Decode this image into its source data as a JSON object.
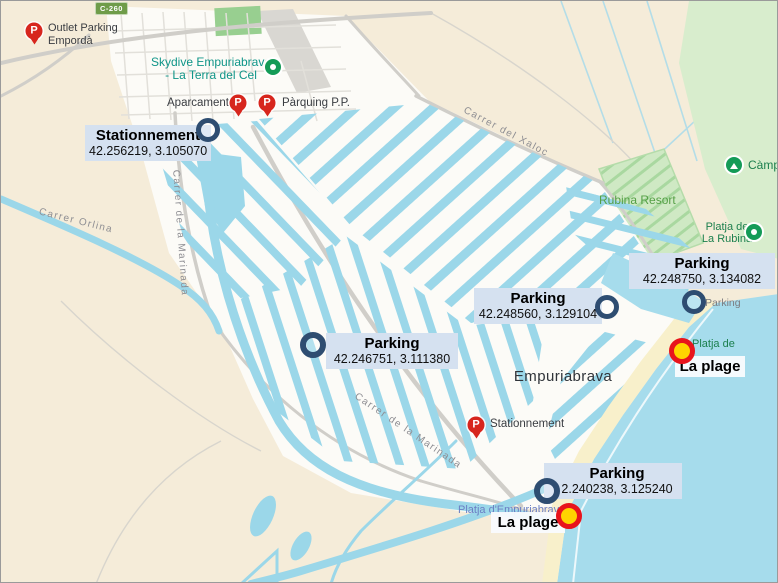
{
  "map_labels": {
    "road_badge": "C-260",
    "outlet_parking_line1": "Outlet Parking",
    "outlet_parking_line2": "Empordà",
    "skydive_line1": "Skydive Empuriabrava",
    "skydive_line2": "- La Terra del Cel",
    "aparcament": "Aparcament",
    "parquing_pp": "Pàrquing P.P.",
    "stationnement_poi": "Stationnement",
    "empuriabrava": "Empuriabrava",
    "rubina_resort": "Rubina Resort",
    "camping": "Càmping",
    "platja_rubina_line1": "Platja de",
    "platja_rubina_line2": "La Rubina",
    "platja_de": "Platja de",
    "platja_empuriabrava": "Platja d'Empuriabrava",
    "parking_small": "Parking",
    "carrer_orlina": "Carrer Orlina",
    "carrer_marinada": "Carrer de la Marinada",
    "carrer_marinada_2": "Carrer de la Marinada",
    "carrer_xaloc": "Carrer del Xaloc"
  },
  "annotations": {
    "stationnement": {
      "title": "Stationnement",
      "coords": "42.256219, 3.105070"
    },
    "parking_w": {
      "title": "Parking",
      "coords": "42.246751, 3.111380"
    },
    "parking_c": {
      "title": "Parking",
      "coords": "42.248560, 3.129104"
    },
    "parking_ne": {
      "title": "Parking",
      "coords": "42.248750, 3.134082"
    },
    "parking_s": {
      "title": "Parking",
      "coords": "2.240238, 3.125240"
    },
    "beach_ne": {
      "title": "La plage"
    },
    "beach_s": {
      "title": "La plage"
    }
  },
  "icons": {
    "parking_glyph": "P"
  },
  "colors": {
    "water": "#9bd7e9",
    "sea": "#a6dcec",
    "land": "#f5ecd9",
    "urban": "#fcfbf7",
    "green": "#d8edcd",
    "camp": "#cfe9c4",
    "sand": "#f8f0cb",
    "annotation_bg": "#d5e1f0",
    "marker_ring": "#2e4d71",
    "beach_fill": "#ffd400",
    "beach_ring": "#e8141c",
    "pmark": "#d7261d"
  }
}
